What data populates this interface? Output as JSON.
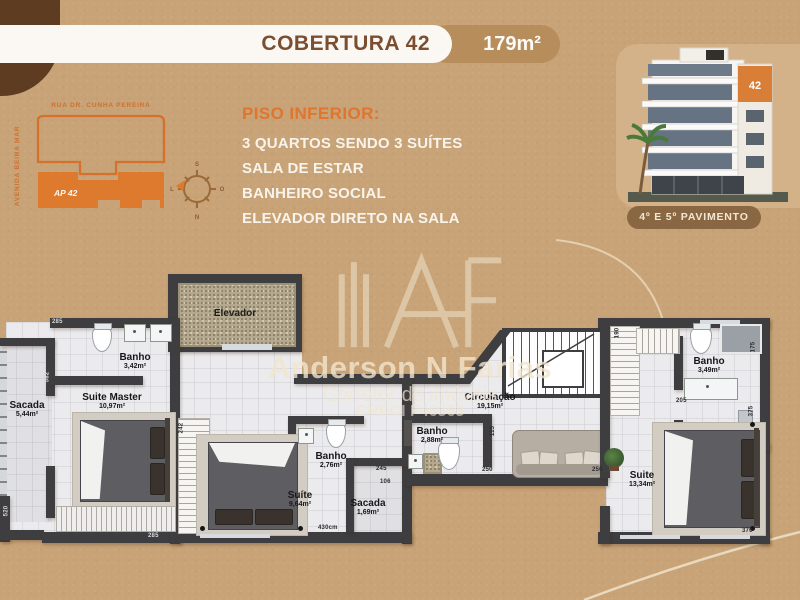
{
  "header": {
    "title": "COBERTURA 42",
    "area_badge": "179m²"
  },
  "sitemap": {
    "street_top": "RUA DR. CUNHA PEREIRA",
    "street_left": "AVENIDA BEIRA MAR",
    "unit": "AP 42",
    "compass": {
      "top": "S",
      "bottom": "N",
      "left": "L",
      "right": "O"
    }
  },
  "features": {
    "heading": "PISO INFERIOR:",
    "lines": [
      "3 QUARTOS SENDO 3 SUÍTES",
      "SALA DE ESTAR",
      "BANHEIRO SOCIAL",
      "ELEVADOR DIRETO NA SALA"
    ]
  },
  "building": {
    "number": "42",
    "caption": "4º E 5º PAVIMENTO"
  },
  "watermark": {
    "name": "Anderson N Farias",
    "role": "Corretor de imóveis",
    "creci": "CRECI F46363"
  },
  "plan": {
    "rooms": {
      "sacada_left": {
        "name": "Sacada",
        "area": "5,44m²"
      },
      "suite_master": {
        "name": "Suite Master",
        "area": "10,97m²"
      },
      "banho_master": {
        "name": "Banho",
        "area": "3,42m²"
      },
      "elevador": {
        "name": "Elevador"
      },
      "banho_meio": {
        "name": "Banho",
        "area": "2,76m²"
      },
      "suite_meio": {
        "name": "Suíte",
        "area": "9,64m²"
      },
      "sacada_meio": {
        "name": "Sacada",
        "area": "1,69m²"
      },
      "banho_social": {
        "name": "Banho",
        "area": "2,88m²"
      },
      "circulacao": {
        "name": "Circulação",
        "area": "19,15m²"
      },
      "banho_dir": {
        "name": "Banho",
        "area": "3,49m²"
      },
      "suite_dir": {
        "name": "Suite",
        "area": "13,34m²"
      }
    },
    "dims": {
      "top_left": "285",
      "left_mid": "582",
      "left_bottom": "520",
      "bottom_left": "285",
      "closet_mid": "242",
      "bottom_center": "430cm",
      "mid_a": "245",
      "mid_b": "106",
      "circ_left": "115",
      "circ_bottom": "250",
      "sofa_bottom": "250",
      "right_top": "190",
      "banho_right": "205",
      "right_side_a": "175",
      "right_side_b": "375",
      "bottom_right": "370"
    }
  },
  "colors": {
    "background_tan": "#C8A377",
    "accent_orange": "#DD7A2E",
    "title_brown": "#7B4E32",
    "corner_brown": "#5E3C22",
    "pill_brown": "#8A6743",
    "wall_gray": "#3E3D40",
    "watermark_cream": "#EFE3CB"
  }
}
